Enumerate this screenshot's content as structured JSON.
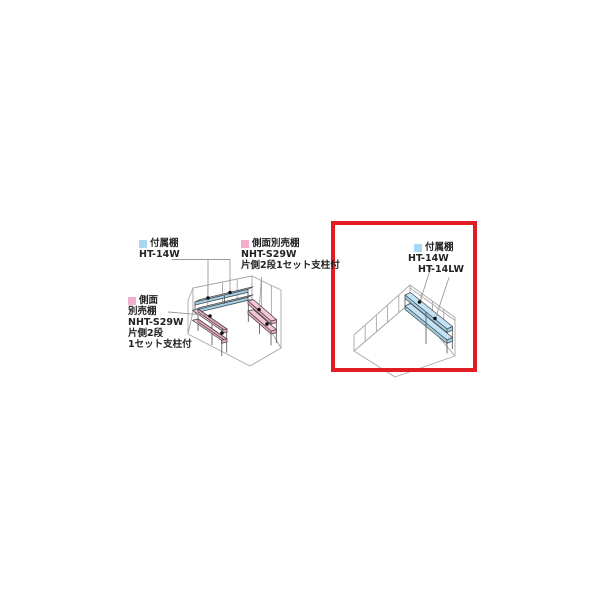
{
  "page": {
    "background_color": "#ffffff",
    "description_icons": [
      "color-swatch-blue",
      "color-swatch-pink"
    ]
  },
  "colors": {
    "attached_shelf_blue": "#A9D7F0",
    "optional_shelf_pink": "#F2AECC",
    "highlight_red": "#E11D23",
    "wall_line_gray": "#A8A8A8",
    "shelf_line_dark": "#4F4F4F",
    "leader_line_gray": "#9A9A9A",
    "text": "#222222"
  },
  "left_diagram": {
    "attached_shelf_label": {
      "lines": [
        "付属棚",
        "HT-14W"
      ]
    },
    "side_shelf_right_label": {
      "lines": [
        "側面別売棚",
        "NHT-S29W",
        "片側2段1セット支柱付"
      ]
    },
    "side_shelf_left_label": {
      "lines": [
        "側面",
        "別売棚",
        "NHT-S29W",
        "片側2段",
        "1セット支柱付"
      ]
    }
  },
  "right_diagram": {
    "attached_shelf_label": {
      "lines": [
        "付属棚",
        "HT-14W",
        "HT-14LW"
      ]
    }
  }
}
